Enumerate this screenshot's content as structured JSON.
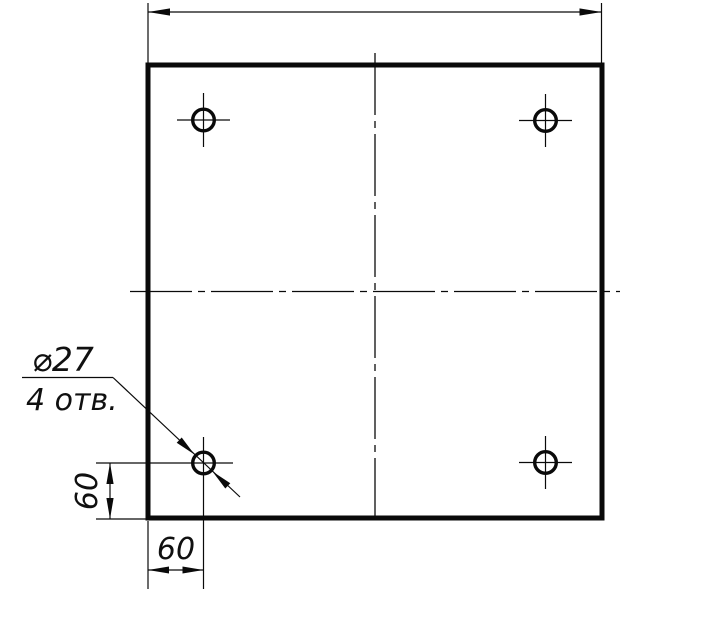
{
  "drawing": {
    "type": "technical-drawing",
    "description_visible": false,
    "line_color": "#0a0a0a",
    "background_color": "#ffffff",
    "labels": {
      "hole_diameter": "⌀27",
      "hole_count": "4 отв.",
      "dim_bottom": "60",
      "dim_left": "60"
    },
    "geometry": {
      "plate": "square plate, outline 148,65 to 602,518",
      "holes": "4 drilled holes ⌀27, one near each corner, offset 60 and 60 from edges",
      "dimensions_shown": [
        {
          "name": "overall-width",
          "value_label": "",
          "location": "top, unlabeled dimension line with outward arrows"
        },
        {
          "name": "hole-offset-x",
          "value_label": "60",
          "location": "bottom left, horizontal"
        },
        {
          "name": "hole-offset-y",
          "value_label": "60",
          "location": "left bottom, vertical (rotated text)"
        },
        {
          "name": "hole-callout",
          "value_label": "⌀27 / 4 отв.",
          "location": "leader to bottom-left hole"
        }
      ]
    }
  }
}
